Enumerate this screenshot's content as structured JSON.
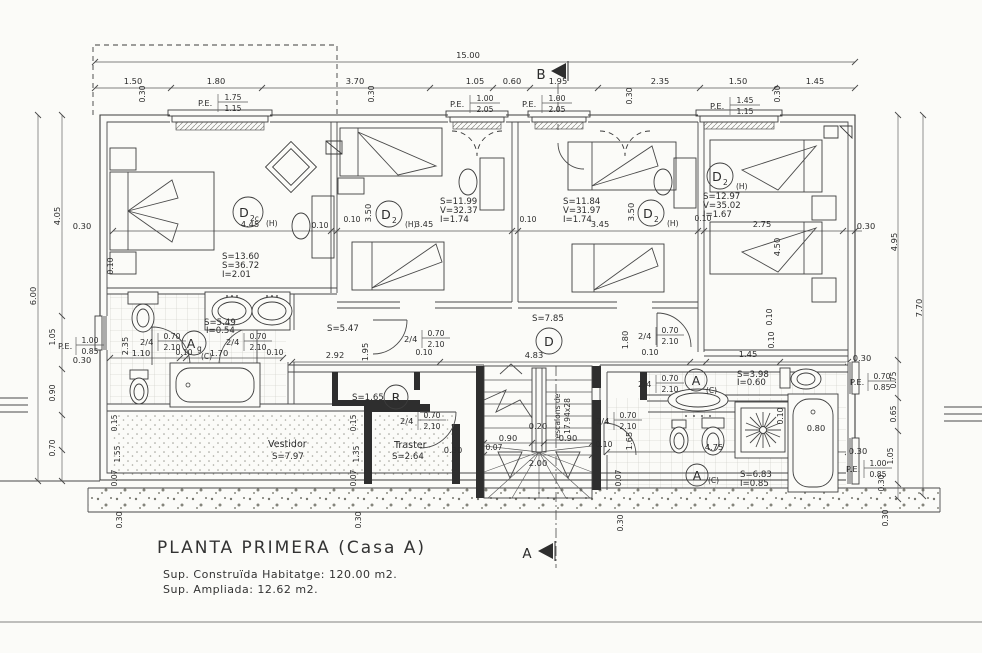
{
  "sheet": {
    "title": "PLANTA PRIMERA (Casa A)",
    "line1": "Sup. Construïda Habitatge: 120.00 m2.",
    "line2": "Sup. Ampliada: 12.62 m2."
  },
  "markers": {
    "b": "B",
    "a": "A"
  },
  "overall": {
    "w": "15.00",
    "h1": "6.00",
    "h2": "4.05",
    "r1": "4.95",
    "r2": "7.70"
  },
  "top": {
    "segs": [
      "1.50",
      "1.80",
      "3.70",
      "1.05",
      "0.60",
      "1.95",
      "2.35",
      "1.50",
      "1.45"
    ],
    "pe": [
      {
        "p": "P.E.",
        "n": "1.75",
        "d": "1.15"
      },
      {
        "p": "P.E.",
        "n": "1.00",
        "d": "2.05"
      },
      {
        "p": "P.E.",
        "n": "1.00",
        "d": "2.05"
      },
      {
        "p": "P.E.",
        "n": "1.45",
        "d": "1.15"
      }
    ]
  },
  "pe_side": {
    "left": {
      "p": "P.E.",
      "n": "1.00",
      "d": "0.85"
    },
    "rt": {
      "p": "P.E.",
      "n": "0.70",
      "d": "0.85"
    },
    "rb": {
      "p": "P.E.",
      "n": "1.00",
      "d": "0.85"
    }
  },
  "door": {
    "p": "2/4",
    "n": "0.70",
    "d": "2.10"
  },
  "rooms": {
    "d2c": {
      "tag": "D",
      "sub": "2c",
      "h": "(H)",
      "a": "S=13.60",
      "b": "S=36.72",
      "c": "I=2.01",
      "w": "4.45"
    },
    "d2a": {
      "tag": "D",
      "sub": "2",
      "h": "(H)",
      "a": "S=11.99",
      "b": "V=32.37",
      "c": "I=1.74",
      "w": "3.45",
      "v": "3.50"
    },
    "d2b": {
      "tag": "D",
      "sub": "2",
      "h": "(H)",
      "a": "S=11.84",
      "b": "V=31.97",
      "c": "I=1.74",
      "w": "3.45",
      "v": "3.50"
    },
    "d2d": {
      "tag": "D",
      "sub": "2",
      "h": "(H)",
      "a": "S=12.97",
      "b": "V=35.02",
      "c": "I=1.67",
      "w": "2.75",
      "v": "4.50"
    }
  },
  "bath1": {
    "tag": "A",
    "sub": "g",
    "c": "(C)",
    "a": "S=5.49",
    "b": "I=0.54",
    "d1": "1.10",
    "d2": "1.70",
    "v": "2.35"
  },
  "hall": {
    "tag": "D",
    "a": "S=5.47",
    "b": "S=7.85",
    "d1": "2.92",
    "d2": "4.83",
    "v1": "1.95",
    "v2": "1.80"
  },
  "room_r": {
    "tag": "R",
    "a": "S=1.65"
  },
  "vestidor": {
    "name": "Vestidor",
    "a": "S=7.97"
  },
  "traster": {
    "name": "Traster",
    "a": "S=2.64",
    "d": "0.30"
  },
  "bath2": {
    "tag": "A",
    "c": "(C)",
    "a": "S=3.98",
    "b": "I=0.60",
    "d1": "1.45"
  },
  "bath3": {
    "tag": "A",
    "c": "(C)",
    "a": "S=6.83",
    "b": "I=0.85",
    "d1": "4.75",
    "d2": "0.80",
    "v1": "1.65"
  },
  "stairs": {
    "a": "0.20",
    "b": "0.90",
    "c": "0.90",
    "d": "2.00",
    "e": "0.07",
    "f": "0.10",
    "n1": "escalons de",
    "n2": "17.94x28"
  },
  "small": {
    "d010": "0.10",
    "d030": "0.30",
    "d015": "0.15",
    "d155": "1.55",
    "d135": "1.35",
    "d007": "0.07",
    "d090": "0.90",
    "d070": "0.70",
    "d105": "1.05",
    "d065": "0.65",
    "d075": "0.75"
  }
}
